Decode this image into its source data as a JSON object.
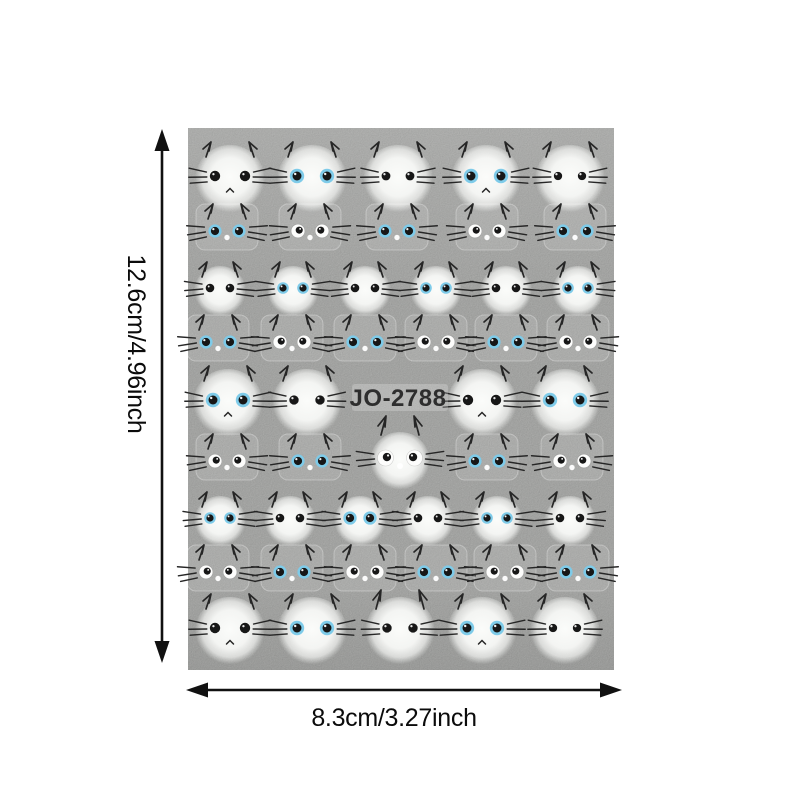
{
  "product_image": {
    "type": "nail-sticker-sheet-photo",
    "sheet": {
      "label": "JO-2788",
      "x": 188,
      "y": 128,
      "width": 426,
      "height": 542
    },
    "dimension_labels": {
      "vertical": "12.6cm/4.96inch",
      "horizontal": "8.3cm/3.27inch"
    },
    "style": {
      "page_bg": "#ffffff",
      "sheet_bg": "#b8b9b7",
      "face_white": "#f8f9f7",
      "eye_black": "#171717",
      "eye_blue": "#7ecbe9",
      "eye_white": "#fdfdfc",
      "whisker": "#262626",
      "arrow": "#111111",
      "dim_text": "#0b0b0b",
      "code_text": "#2e2e2e"
    },
    "cats": {
      "eye_styles_legend": [
        "black = solid black eyes",
        "blue = blue-ringed eyes",
        "white = googly white eyes"
      ],
      "rows": [
        {
          "y": 176,
          "size": "L",
          "faces": [
            {
              "x": 230,
              "e": "black",
              "m": "caret"
            },
            {
              "x": 312,
              "e": "blue"
            },
            {
              "x": 398,
              "e": "black",
              "es": 0.85,
              "g": 24
            },
            {
              "x": 486,
              "e": "blue",
              "m": "caret"
            },
            {
              "x": 570,
              "e": "black",
              "es": 0.8,
              "g": 24
            }
          ]
        },
        {
          "y": 231,
          "size": "S",
          "faces": [
            {
              "x": 227,
              "e": "blue"
            },
            {
              "x": 310,
              "e": "white"
            },
            {
              "x": 397,
              "e": "blue"
            },
            {
              "x": 487,
              "e": "white"
            },
            {
              "x": 575,
              "e": "blue"
            }
          ]
        },
        {
          "y": 288,
          "size": "M",
          "faces": [
            {
              "x": 220,
              "e": "black"
            },
            {
              "x": 293,
              "e": "blue"
            },
            {
              "x": 365,
              "e": "black"
            },
            {
              "x": 436,
              "e": "blue"
            },
            {
              "x": 506,
              "e": "black"
            },
            {
              "x": 578,
              "e": "blue"
            }
          ]
        },
        {
          "y": 342,
          "size": "S",
          "faces": [
            {
              "x": 218,
              "e": "blue"
            },
            {
              "x": 292,
              "e": "white"
            },
            {
              "x": 365,
              "e": "blue"
            },
            {
              "x": 436,
              "e": "white"
            },
            {
              "x": 506,
              "e": "blue"
            },
            {
              "x": 578,
              "e": "white"
            }
          ]
        },
        {
          "y": 400,
          "size": "L",
          "faces": [
            {
              "x": 228,
              "e": "blue",
              "m": "caret"
            },
            {
              "x": 307,
              "e": "black",
              "g": 26,
              "es": 0.9
            },
            {
              "x": 482,
              "e": "black",
              "m": "caret",
              "g": 28
            },
            {
              "x": 565,
              "e": "blue"
            }
          ]
        },
        {
          "y": 461,
          "size": "S",
          "faces": [
            {
              "x": 227,
              "e": "white"
            },
            {
              "x": 310,
              "e": "blue"
            },
            {
              "x": 400,
              "e": "white",
              "size": "C",
              "dy": -3
            },
            {
              "x": 487,
              "e": "blue"
            },
            {
              "x": 572,
              "e": "white"
            }
          ]
        },
        {
          "y": 518,
          "size": "M",
          "faces": [
            {
              "x": 220,
              "e": "blue"
            },
            {
              "x": 290,
              "e": "black"
            },
            {
              "x": 360,
              "e": "blue",
              "es": 1.15
            },
            {
              "x": 428,
              "e": "black"
            },
            {
              "x": 497,
              "e": "blue"
            },
            {
              "x": 570,
              "e": "black"
            }
          ]
        },
        {
          "y": 572,
          "size": "S",
          "faces": [
            {
              "x": 218,
              "e": "white"
            },
            {
              "x": 292,
              "e": "blue"
            },
            {
              "x": 365,
              "e": "white"
            },
            {
              "x": 436,
              "e": "blue"
            },
            {
              "x": 505,
              "e": "white"
            },
            {
              "x": 578,
              "e": "blue"
            }
          ]
        },
        {
          "y": 628,
          "size": "L",
          "faces": [
            {
              "x": 230,
              "e": "black",
              "m": "caret"
            },
            {
              "x": 312,
              "e": "blue"
            },
            {
              "x": 400,
              "e": "black",
              "tall": true,
              "g": 26,
              "es": 0.9
            },
            {
              "x": 482,
              "e": "blue",
              "m": "caret"
            },
            {
              "x": 565,
              "e": "black",
              "es": 0.8,
              "g": 24
            }
          ]
        }
      ]
    }
  }
}
